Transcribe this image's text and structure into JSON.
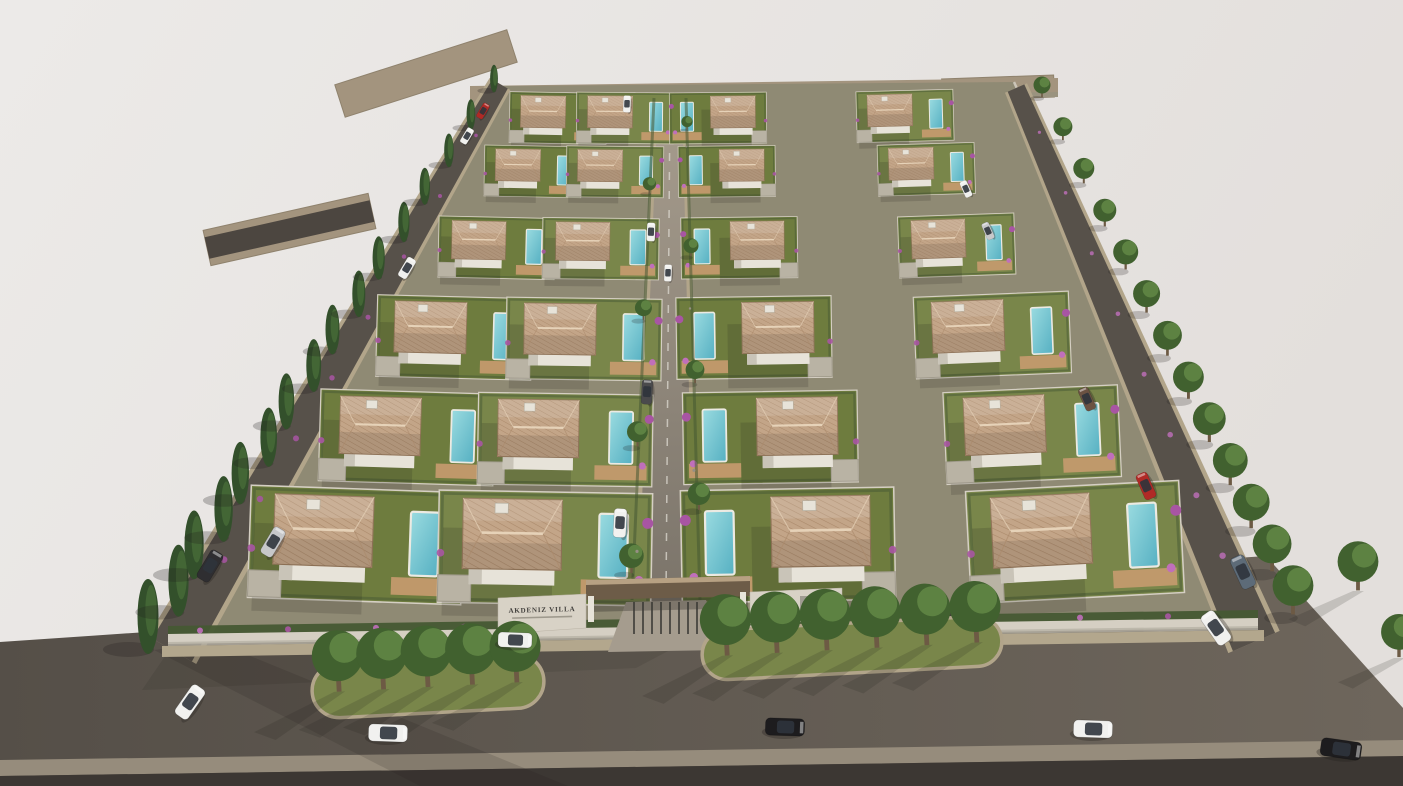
{
  "scene": {
    "type": "3d-architectural-render",
    "description": "Aerial 3D architectural rendering of the AKDENIZ VILLA gated residential development: 24 white two-storey villas with terracotta hipped roofs, private pools, wooden decks and lawns arranged in four columns along a central cobbled street, enclosed by a white perimeter wall, flanked by perimeter roads lined with cypress and deciduous trees, with a front boulevard, landscaped tree medians, an entrance gate canopy and scattered cars.",
    "sign": {
      "title": "AKDENIZ VILLA"
    },
    "counts": {
      "villas": 24,
      "villa_rows": 6,
      "villa_columns": 4,
      "cars": 22,
      "cypress_trees": 16,
      "street_trees_right": 13,
      "median_islands": 2,
      "median_trees": 11
    },
    "palette": {
      "background": "#eceae8",
      "background_edge": "#e3dfdc",
      "asphalt_front_dark": "#554f48",
      "asphalt_front_light": "#6e665c",
      "asphalt_perimeter": "#57514a",
      "asphalt_dark": "#4c4640",
      "curb": "#b2a58a",
      "road_stub": "#a3947e",
      "road_stub_edge": "#8f826d",
      "central_road_top": "#a79d8e",
      "central_road_bottom": "#7b746a",
      "road_dash": "#d8d4cb",
      "sidewalk": "#b3a78d",
      "sidewalk_bottom": "#968c7c",
      "sidewalk_edge_dark": "#3c3733",
      "site_base": "#8f8a74",
      "lawn": "#6e7c3e",
      "lawn_alt": "#79864a",
      "hedge": "#465833",
      "wall_white": "#d5cfc3",
      "wall_shade": "#b7b1a5",
      "house_wall": "#e7e3d9",
      "house_shade": "#c9c4b8",
      "roof": "#c3a588",
      "roof_line": "#ab8a6b",
      "roof_ridge": "#e6d2b8",
      "roof_edge": "#93765a",
      "pool_light": "#9adbe0",
      "pool_dark": "#56b0c2",
      "pool_rim": "#eceae2",
      "deck": "#c39a6d",
      "garage": "#b9b3a4",
      "cypress": "#33502b",
      "cypress_light": "#476b38",
      "tree": "#41612f",
      "tree_light": "#69904a",
      "trunk": "#6d5a44",
      "bougainvillea": "#a855a3",
      "bougainvillea_light": "#c06fbb",
      "canopy": "#6d5c48",
      "canopy_fascia": "#b7a183",
      "gate_dark": "#3c3a36",
      "sign_wall": "#d8d2c6",
      "sign_text": "#413f3c",
      "shadow": "#201d1a",
      "cars": {
        "white": "#f1f1ef",
        "silver": "#c7c8ca",
        "black": "#1d1c1e",
        "dark": "#2f2e31",
        "red": "#b02a26",
        "slate": "#5d6b78",
        "brown": "#6b5242",
        "charcoal": "#4a4a4c",
        "glass": "#2f343c"
      }
    },
    "geometry": {
      "site": {
        "front_left": [
          168,
          638
        ],
        "front_right": [
          1258,
          620
        ],
        "back_left": [
          500,
          86
        ],
        "back_right": [
          1014,
          82
        ]
      },
      "roads": {
        "front": [
          [
            0,
            642
          ],
          [
            1266,
            556
          ],
          [
            1403,
            708
          ],
          [
            1403,
            786
          ],
          [
            0,
            786
          ]
        ],
        "left": {
          "from": [
            172,
            650
          ],
          "to": [
            500,
            84
          ],
          "w0": 46,
          "w1": 18
        },
        "right": {
          "from": [
            1254,
            642
          ],
          "to": [
            1016,
            88
          ],
          "w0": 46,
          "w1": 18
        },
        "central": {
          "from": [
            666,
            602
          ],
          "to": [
            670,
            96
          ],
          "w0": 56,
          "w1": 24
        },
        "stub_top_left": {
          "from": [
            340,
            101
          ],
          "to": [
            512,
            46
          ],
          "w": 34
        },
        "stub_mid_left": {
          "from": [
            207,
            248
          ],
          "to": [
            372,
            211
          ],
          "w": 22
        },
        "stub_top_right": {
          "from": [
            942,
            90
          ],
          "to": [
            1054,
            86
          ],
          "w": 22
        },
        "back": [
          [
            470,
            86
          ],
          [
            1058,
            78
          ],
          [
            1058,
            94
          ],
          [
            470,
            103
          ]
        ]
      },
      "villas": {
        "columns": [
          {
            "front": [
              356,
              545
            ],
            "back": [
              558,
              118
            ],
            "pool_side": 1,
            "rot": 2
          },
          {
            "front": [
              545,
              548
            ],
            "back": [
              625,
              118
            ],
            "pool_side": 1,
            "rot": 1
          },
          {
            "front": [
              788,
              545
            ],
            "back": [
              718,
              118
            ],
            "pool_side": -1,
            "rot": -1
          },
          {
            "front": [
              1075,
              542
            ],
            "back": [
              905,
              116
            ],
            "pool_side": 1,
            "rot": -3
          }
        ],
        "row_t": [
          0,
          0.252,
          0.486,
          0.696,
          0.875,
          1
        ],
        "scale_front": 1.05,
        "scale_back": 0.46
      },
      "tree_lines": {
        "cypress_left": {
          "from": [
            152,
            642
          ],
          "to": [
            494,
            88
          ],
          "count": 16,
          "s0": 1.5,
          "s1": 0.55
        },
        "street_right": {
          "from": [
            1293,
            612
          ],
          "to": [
            1042,
            96
          ],
          "count": 13,
          "s0": 1.2,
          "s1": 0.5
        },
        "central_garden_trees": {
          "count": 8
        }
      },
      "medians": [
        {
          "cx": 428,
          "cy": 686,
          "w": 232,
          "h": 54,
          "rot": -3,
          "trees": 5
        },
        {
          "cx": 852,
          "cy": 648,
          "w": 300,
          "h": 50,
          "rot": -3,
          "trees": 6
        }
      ],
      "corner_trees": [
        [
          1358,
          588,
          1.2
        ],
        [
          1399,
          655,
          1.05
        ]
      ]
    },
    "cars": [
      {
        "x": 190,
        "y": 702,
        "deg": -55,
        "color": "white",
        "s": 1.05
      },
      {
        "x": 388,
        "y": 733,
        "deg": 2,
        "color": "white",
        "s": 1.15
      },
      {
        "x": 515,
        "y": 640,
        "deg": 2,
        "color": "white",
        "s": 1.0
      },
      {
        "x": 785,
        "y": 727,
        "deg": 2,
        "color": "black",
        "s": 1.15
      },
      {
        "x": 1093,
        "y": 729,
        "deg": 2,
        "color": "white",
        "s": 1.15
      },
      {
        "x": 1341,
        "y": 749,
        "deg": 8,
        "color": "black",
        "s": 1.2
      },
      {
        "x": 1243,
        "y": 572,
        "deg": -115,
        "color": "slate",
        "s": 1.0
      },
      {
        "x": 1216,
        "y": 628,
        "deg": -125,
        "color": "white",
        "s": 1.05
      },
      {
        "x": 210,
        "y": 566,
        "deg": -59,
        "color": "dark",
        "s": 0.95
      },
      {
        "x": 273,
        "y": 542,
        "deg": -59,
        "color": "silver",
        "s": 0.9
      },
      {
        "x": 407,
        "y": 268,
        "deg": -59,
        "color": "white",
        "s": 0.65
      },
      {
        "x": 467,
        "y": 136,
        "deg": -59,
        "color": "white",
        "s": 0.5
      },
      {
        "x": 483,
        "y": 111,
        "deg": -59,
        "color": "red",
        "s": 0.48
      },
      {
        "x": 627,
        "y": 104,
        "deg": -88,
        "color": "white",
        "s": 0.5
      },
      {
        "x": 651,
        "y": 232,
        "deg": -88,
        "color": "white",
        "s": 0.55
      },
      {
        "x": 668,
        "y": 273,
        "deg": -88,
        "color": "white",
        "s": 0.5
      },
      {
        "x": 647,
        "y": 392,
        "deg": -87,
        "color": "charcoal",
        "s": 0.72
      },
      {
        "x": 620,
        "y": 523,
        "deg": -87,
        "color": "white",
        "s": 0.85
      },
      {
        "x": 1087,
        "y": 399,
        "deg": -114,
        "color": "brown",
        "s": 0.7
      },
      {
        "x": 1146,
        "y": 486,
        "deg": -114,
        "color": "red",
        "s": 0.8
      },
      {
        "x": 966,
        "y": 189,
        "deg": -114,
        "color": "white",
        "s": 0.5
      },
      {
        "x": 988,
        "y": 231,
        "deg": -114,
        "color": "silver",
        "s": 0.52
      }
    ]
  }
}
